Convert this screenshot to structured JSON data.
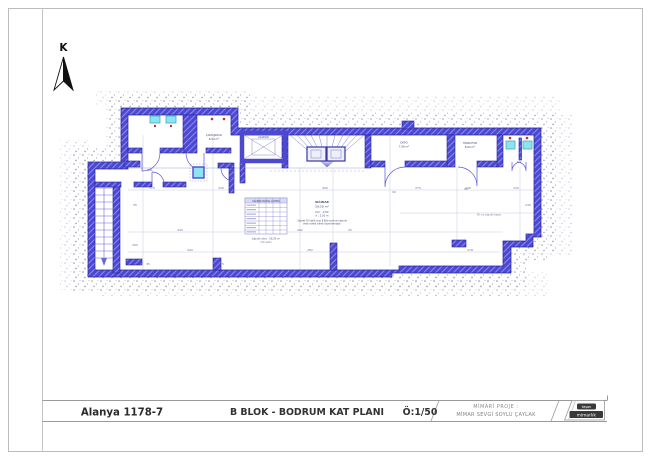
{
  "page": {
    "north_label": "K"
  },
  "title_block": {
    "project_code": "Alanya 1178-7",
    "drawing_title": "B BLOK - BODRUM KAT PLANI",
    "scale_label": "Ö:1/50",
    "architect_heading": "MİMARİ PROJE :",
    "architect_name": "MİMAR SEVGİ SOYLU ÇAYLAK",
    "logo_top": "taşan",
    "logo_bottom": "mimarlık"
  },
  "plan": {
    "colors": {
      "wall": "#4c49d0",
      "wall_hatch": "#8f8df2",
      "fixture": "#8fe3ee",
      "accent_red": "#c43030",
      "dim": "#6d74a0"
    },
    "rooms": [
      {
        "t": "ÇAMAŞIRLIK",
        "x": 214,
        "y": 136,
        "s": 2.7
      },
      {
        "t": "8,94 m²",
        "x": 214,
        "y": 140,
        "s": 2.7
      },
      {
        "t": "DEPO",
        "x": 404,
        "y": 143.5,
        "s": 2.7
      },
      {
        "t": "7,96 m²",
        "x": 404,
        "y": 147.5,
        "s": 2.7
      },
      {
        "t": "HİDROFOR",
        "x": 470,
        "y": 144,
        "s": 2.7
      },
      {
        "t": "8,60 m²",
        "x": 470,
        "y": 148,
        "s": 2.7
      },
      {
        "t": "ASANSÖR",
        "x": 263.5,
        "y": 138,
        "s": 2.2
      },
      {
        "t": "HOL",
        "x": 150,
        "y": 171,
        "s": 2.6
      }
    ],
    "notes": [
      {
        "t": "SIĞINAK",
        "x": 322,
        "y": 203,
        "s": 3,
        "b": true
      },
      {
        "t": "58,28 m²",
        "x": 322,
        "y": 207.5,
        "s": 3
      },
      {
        "t": "Kot : -2,80",
        "x": 322,
        "y": 213,
        "s": 2.5
      },
      {
        "t": "h : 2,20 m",
        "x": 322,
        "y": 216.5,
        "s": 2.5
      },
      {
        "t": "Sığınak 50 kişilik olup B Blok bodrum katında",
        "x": 322,
        "y": 221.5,
        "s": 2.2
      },
      {
        "t": "ortak mahal olarak düzenlenmiştir.",
        "x": 322,
        "y": 224.5,
        "s": 2.2
      },
      {
        "t": "90 cm sığınak kapısı",
        "x": 489,
        "y": 215.5,
        "s": 2.4,
        "c": "#7a80a0"
      }
    ],
    "schedule": {
      "caption": "SIĞINAK MAHAL LİSTESİ",
      "footnotes": [
        {
          "t": "Sığınak alanı : 58,28 m²",
          "x": 266,
          "y": 239.5,
          "s": 2.4,
          "c": "#5a5f8a"
        },
        {
          "t": "(50 kişilik)",
          "x": 266,
          "y": 243,
          "s": 2.2,
          "c": "#7a80a0"
        }
      ]
    },
    "dimensions": [
      {
        "t": "170",
        "x": 152,
        "y": 189
      },
      {
        "t": "245",
        "x": 221,
        "y": 189
      },
      {
        "t": "490",
        "x": 325,
        "y": 189
      },
      {
        "t": "275",
        "x": 418,
        "y": 189
      },
      {
        "t": "238",
        "x": 468,
        "y": 189
      },
      {
        "t": "230",
        "x": 516,
        "y": 189
      },
      {
        "t": "440",
        "x": 180,
        "y": 231
      },
      {
        "t": "282",
        "x": 300,
        "y": 231
      },
      {
        "t": "25",
        "x": 350,
        "y": 231
      },
      {
        "t": "440",
        "x": 190,
        "y": 251
      },
      {
        "t": "282",
        "x": 310,
        "y": 251
      },
      {
        "t": "218",
        "x": 470,
        "y": 251
      },
      {
        "t": "35",
        "x": 148,
        "y": 265
      },
      {
        "t": "25",
        "x": 222,
        "y": 265
      },
      {
        "t": "95",
        "x": 135,
        "y": 206
      },
      {
        "t": "305",
        "x": 135,
        "y": 246
      },
      {
        "t": "230",
        "x": 528,
        "y": 206
      },
      {
        "t": "90",
        "x": 394,
        "y": 193
      },
      {
        "t": "90",
        "x": 466,
        "y": 190
      }
    ]
  }
}
